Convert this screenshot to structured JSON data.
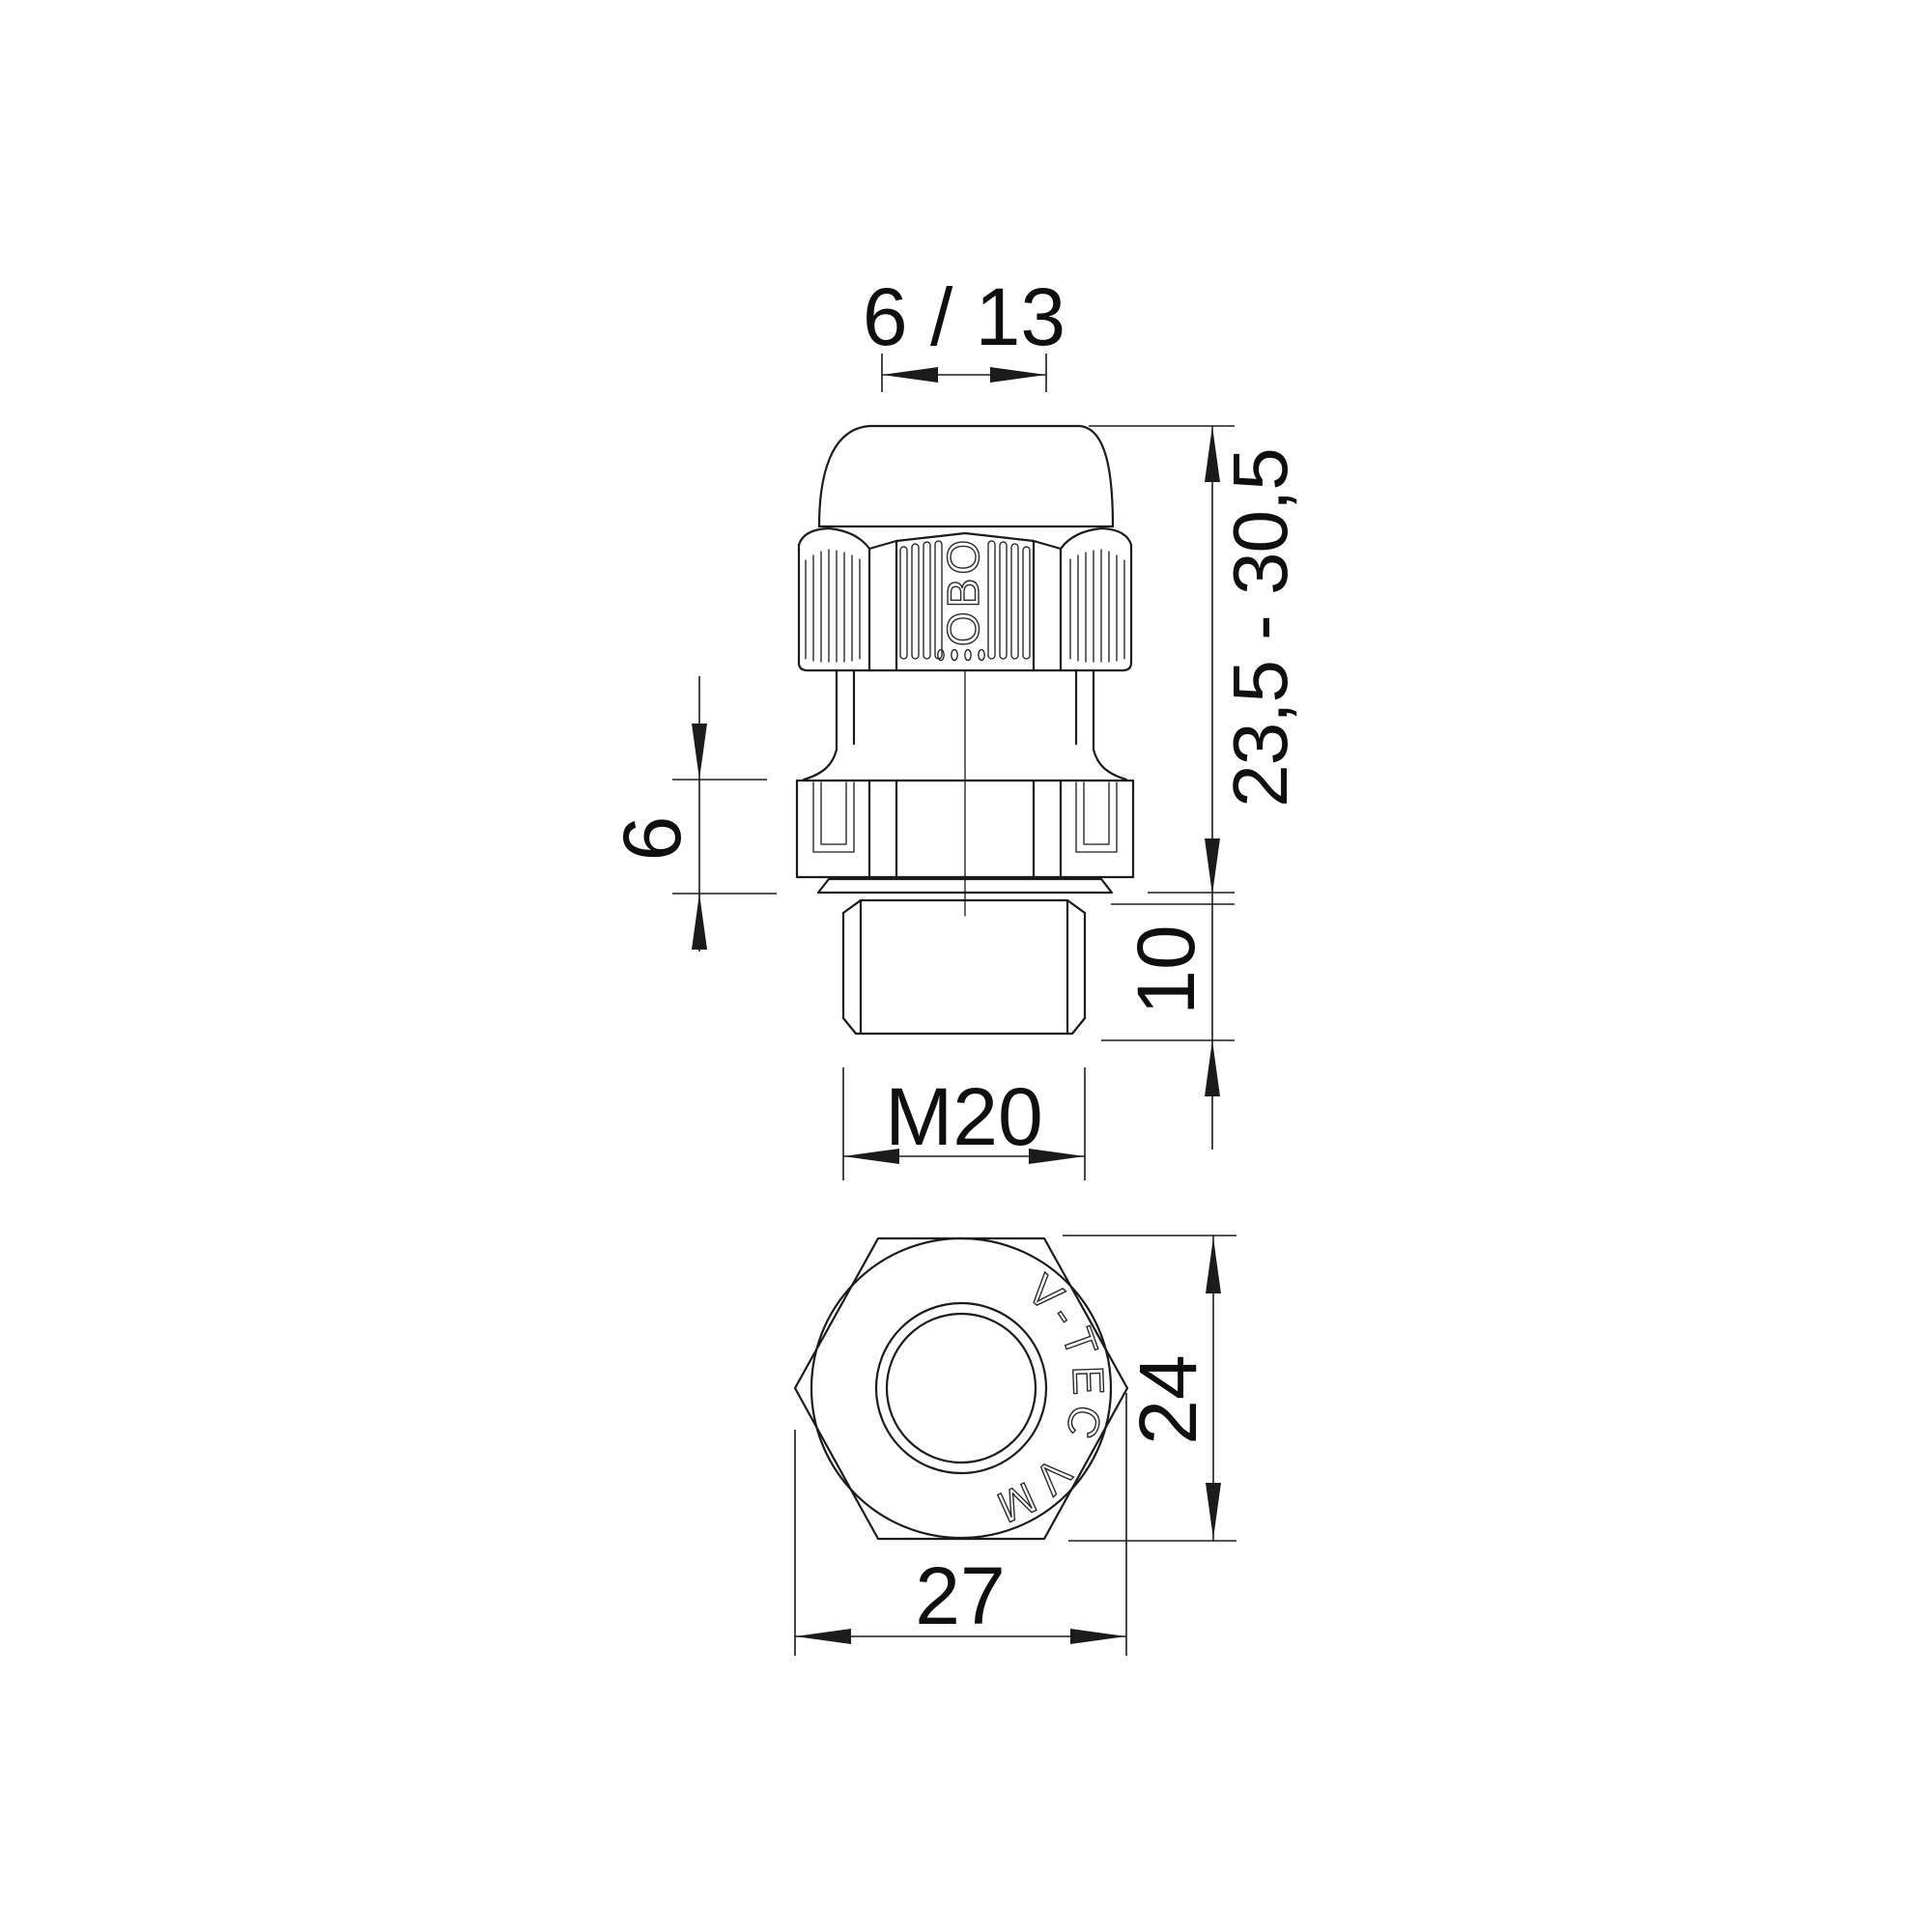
{
  "page": {
    "background": "#ffffff"
  },
  "drawing": {
    "kind": "technical-dimension-drawing",
    "part": "cable-gland",
    "colors": {
      "line": "#1b1b1b",
      "text": "#0f0f0f",
      "background": "#ffffff"
    },
    "side_view": {
      "cap_marking": "OBO"
    },
    "bottom_view": {
      "marking": "V-TEC VM"
    },
    "dimensions": {
      "clamping_range": "6 / 13",
      "body_height_range": "23,5 - 30,5",
      "collar_height": "6",
      "thread_length": "10",
      "thread_size": "M20",
      "across_flats": "24",
      "across_corners": "27"
    }
  }
}
